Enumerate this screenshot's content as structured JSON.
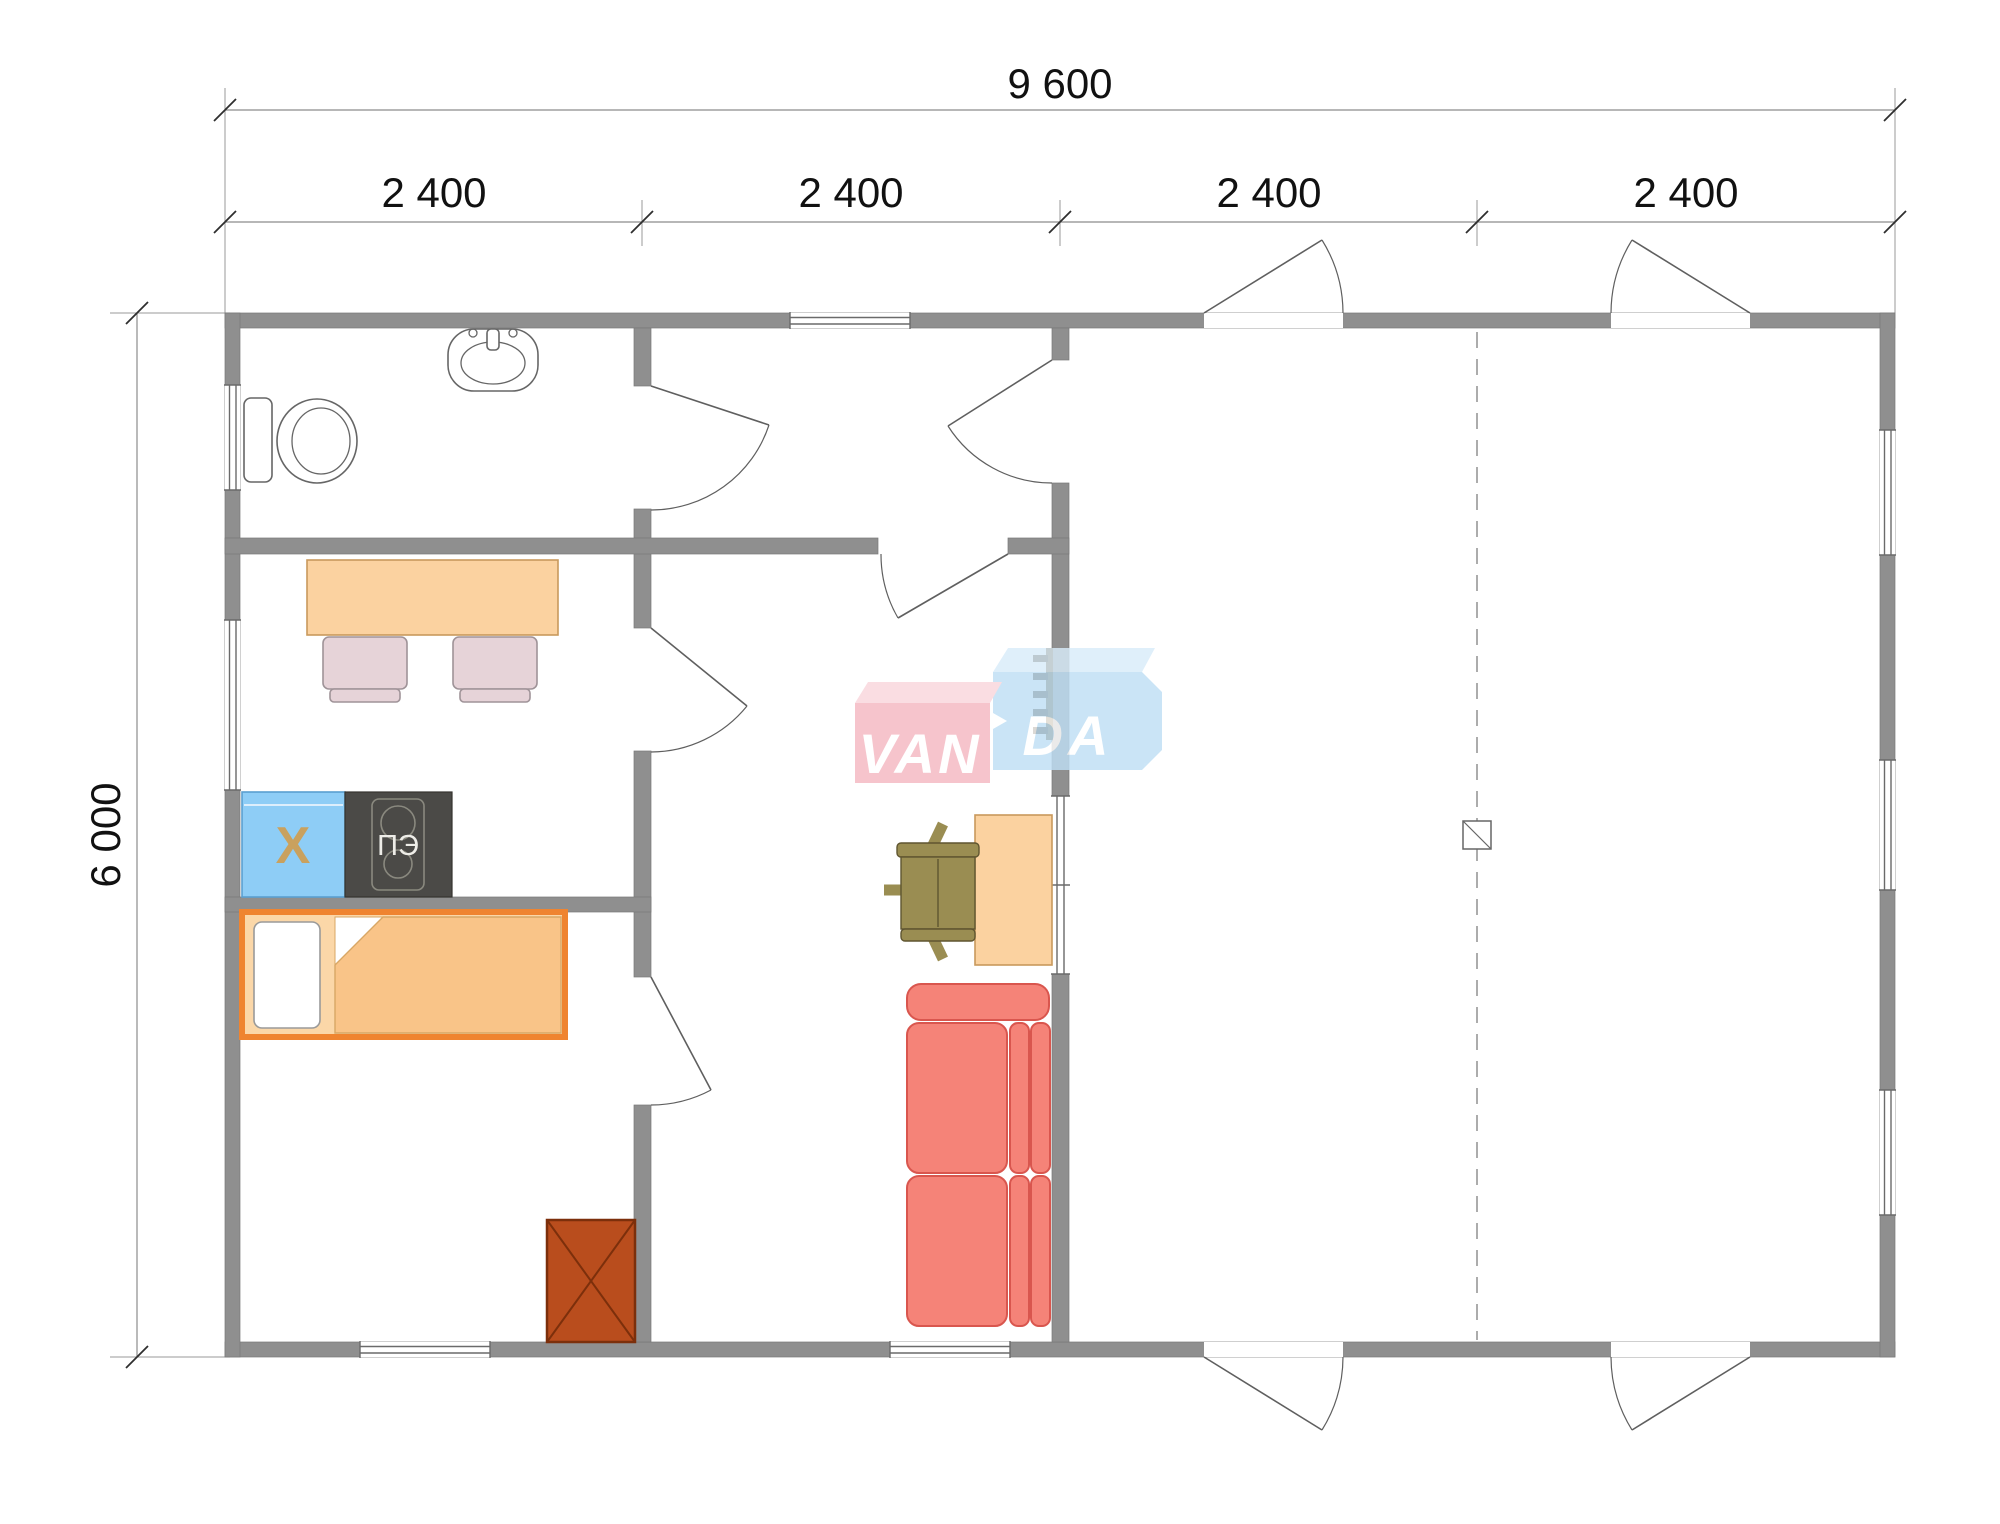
{
  "dimensions": {
    "total_width": "9 600",
    "modules": [
      "2 400",
      "2 400",
      "2 400",
      "2 400"
    ],
    "total_height": "6 000"
  },
  "appliance_labels": {
    "fridge": "Х",
    "stove": "ПЭ"
  },
  "watermark": {
    "full": "VANDA",
    "left": "VAN",
    "right": "DA",
    "pink": "#f5b8c2",
    "blue": "#bfdff5"
  },
  "colors": {
    "wall": "#8f8f8f",
    "furniture_tan": "#fbd2a0",
    "bed_border": "#ef8430",
    "fridge_blue": "#8ecdf6",
    "stove_dark": "#4b4a47",
    "sofa_red": "#f58378",
    "wardrobe_brown": "#b94d1d",
    "dining_chair_pink": "#e6d3d8",
    "office_chair_olive": "#9a8d52"
  }
}
